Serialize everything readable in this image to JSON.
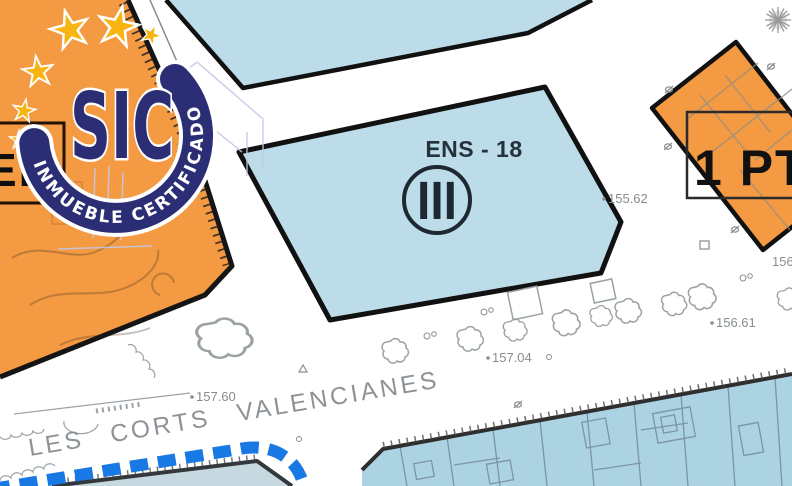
{
  "watermark": {
    "acronym": "SIC",
    "ring_text": "INMUEBLE CERTIFICADO",
    "ring_color": "#2b2e74",
    "star_color": "#F8B511"
  },
  "map": {
    "zone": {
      "label": "ENS - 18",
      "floors_symbol": "III"
    },
    "parcel_right_label": "1 PT",
    "parcel_left_label": "EL",
    "street_name": "LES CORTS VALENCIANES",
    "elevations": {
      "a": "155.62",
      "b": "156.61",
      "c": "157.04",
      "d": "157.60",
      "e": "156",
      "f": "15"
    },
    "colors": {
      "parcel_orange": "#F39A42",
      "zone_blue": "#BCDCE9",
      "zone_blue_bottom": "#ACD3E2",
      "zone_blue_corner": "#C6D9E0",
      "route_blue": "#1878E4"
    }
  }
}
